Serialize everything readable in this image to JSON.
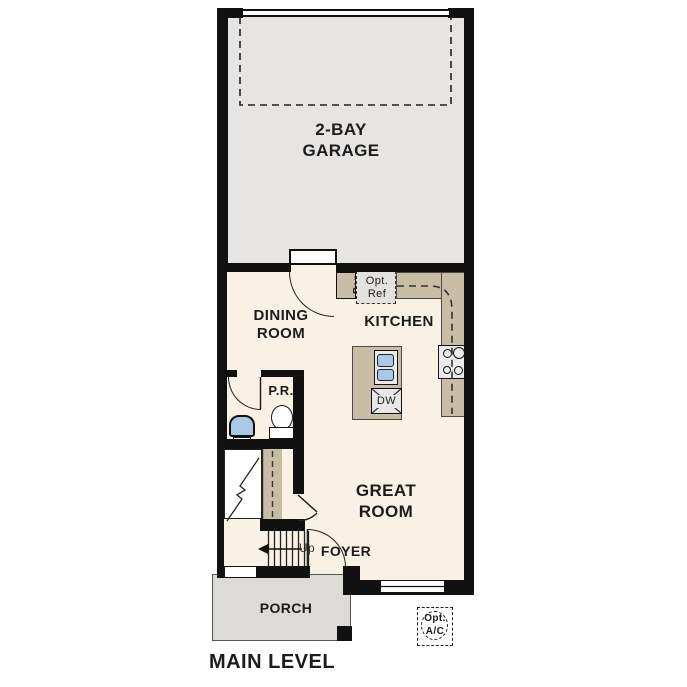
{
  "page": {
    "title": "MAIN LEVEL"
  },
  "rooms": {
    "garage": "2-BAY\nGARAGE",
    "dining": "DINING\nROOM",
    "kitchen": "KITCHEN",
    "powder": "P.R.",
    "great": "GREAT\nROOM",
    "foyer": "FOYER",
    "porch": "PORCH"
  },
  "fixtures": {
    "pantry": "Pan",
    "opt_ref": "Opt.\nRef",
    "dishwasher": "DW",
    "stair_direction": "Up",
    "opt_ac": "Opt.\nA/C"
  },
  "colors": {
    "wall": "#111111",
    "garage_floor": "#e6e5e3",
    "main_floor": "#f9f1e4",
    "counter_tan": "#c9bda6",
    "porch_gray": "#dcdbd8",
    "fixture_gray": "#ebebeb",
    "sink_blue": "#aac9e6"
  }
}
